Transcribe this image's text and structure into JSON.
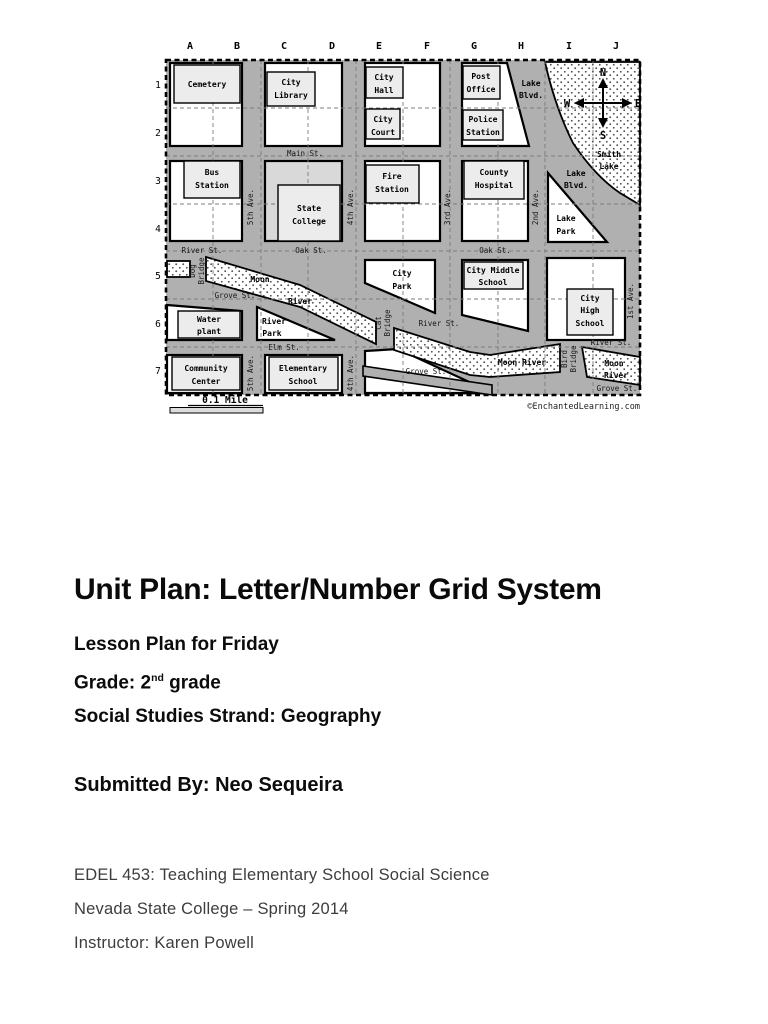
{
  "document": {
    "title": "Unit Plan: Letter/Number Grid System",
    "lesson": "Lesson Plan for Friday",
    "grade_prefix": "Grade: 2",
    "grade_ordinal": "nd",
    "grade_suffix": " grade",
    "strand": "Social Studies Strand: Geography",
    "submitted": "Submitted By: Neo Sequeira",
    "course": "EDEL 453: Teaching Elementary School Social Science",
    "school_term": "Nevada State College – Spring 2014",
    "instructor": "Instructor:  Karen Powell"
  },
  "map": {
    "credit": "©EnchantedLearning.com",
    "scale": "0.1 Mile",
    "grid": {
      "letters": [
        "A",
        "B",
        "C",
        "D",
        "E",
        "F",
        "G",
        "H",
        "I",
        "J"
      ],
      "numbers": [
        "1",
        "2",
        "3",
        "4",
        "5",
        "6",
        "7"
      ]
    },
    "compass": {
      "n": "N",
      "s": "S",
      "e": "E",
      "w": "W"
    },
    "streets": {
      "main": "Main St.",
      "river": "River St.",
      "oak": "Oak St.",
      "grove": "Grove St.",
      "elm": "Elm St.",
      "ave5": "5th Ave.",
      "ave4": "4th Ave.",
      "ave3": "3rd Ave.",
      "ave2": "2nd Ave.",
      "ave1": "1st Ave."
    },
    "places": {
      "cemetery": [
        "Cemetery"
      ],
      "city_library": [
        "City",
        "Library"
      ],
      "city_hall": [
        "City",
        "Hall"
      ],
      "city_court": [
        "City",
        "Court"
      ],
      "post_office": [
        "Post",
        "Office"
      ],
      "police_station": [
        "Police",
        "Station"
      ],
      "bus_station": [
        "Bus",
        "Station"
      ],
      "state_college": [
        "State",
        "College"
      ],
      "fire_station": [
        "Fire",
        "Station"
      ],
      "county_hospital": [
        "County",
        "Hospital"
      ],
      "lake_blvd": [
        "Lake",
        "Blvd."
      ],
      "lake_park": [
        "Lake",
        "Park"
      ],
      "smith_lake": [
        "Smith",
        "Lake"
      ],
      "city_park": [
        "City",
        "Park"
      ],
      "city_middle_school": [
        "City Middle",
        "School"
      ],
      "city_high_school": [
        "City",
        "High",
        "School"
      ],
      "water_plant": [
        "Water",
        "plant"
      ],
      "river_park": [
        "River",
        "Park"
      ],
      "community_center": [
        "Community",
        "Center"
      ],
      "elementary_school": [
        "Elementary",
        "School"
      ],
      "moon_river_upper": [
        "Moon",
        "River"
      ],
      "moon_river_mid": [
        "Moon River"
      ],
      "moon_river_corner": [
        "Moon",
        "River"
      ],
      "dog_bridge": [
        "Dog",
        "Bridge"
      ],
      "cat_bridge": [
        "Cat",
        "Bridge"
      ],
      "bird_bridge": [
        "Bird",
        "Bridge"
      ]
    },
    "colors": {
      "road_gray": "#b0b0b0",
      "block_white": "#ffffff",
      "building_fill": "#ececec",
      "college_block": "#d9d9d9"
    }
  }
}
